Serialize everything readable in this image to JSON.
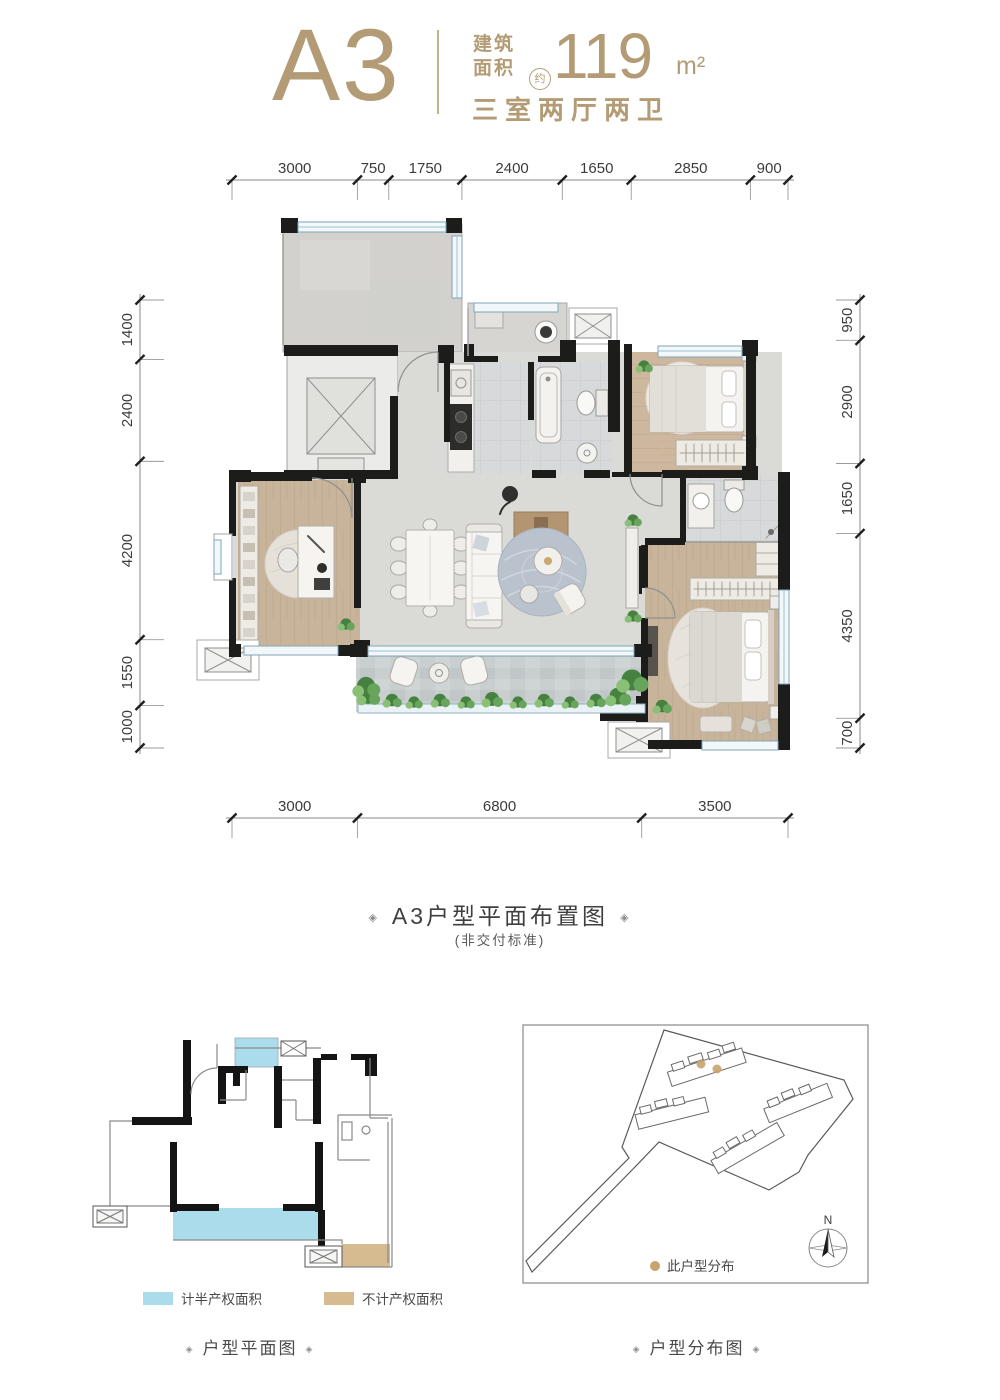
{
  "header": {
    "unit_name": "A3",
    "area_label_top": "建筑",
    "area_label_bottom": "面积",
    "area_approx": "约",
    "area_value": "119",
    "area_unit": "m²",
    "layout_desc": "三室两厅两卫"
  },
  "floor_plan": {
    "dims_top": [
      "3000",
      "750",
      "1750",
      "2400",
      "1650",
      "2850",
      "900"
    ],
    "dims_bottom": [
      "3000",
      "6800",
      "3500"
    ],
    "dims_left": [
      "1400",
      "2400",
      "4200",
      "1550",
      "1000"
    ],
    "dims_right": [
      "950",
      "2900",
      "1650",
      "4350",
      "700"
    ]
  },
  "captions": {
    "ornament": "◈",
    "main_title": "A3户型平面布置图",
    "main_note": "(非交付标准)",
    "small_plan": "户型平面图",
    "site_plan": "户型分布图"
  },
  "legend": {
    "half_property": "计半产权面积",
    "excluded_property": "不计产权面积"
  },
  "site": {
    "unit_marker_label": "此户型分布",
    "north_label": "N"
  },
  "colors": {
    "brand_gold": "#b39c75",
    "legend_blue": "#aadcec",
    "legend_tan": "#d6ba90",
    "marker_gold": "#c8a36e",
    "wall_black": "#1c1c1a"
  }
}
